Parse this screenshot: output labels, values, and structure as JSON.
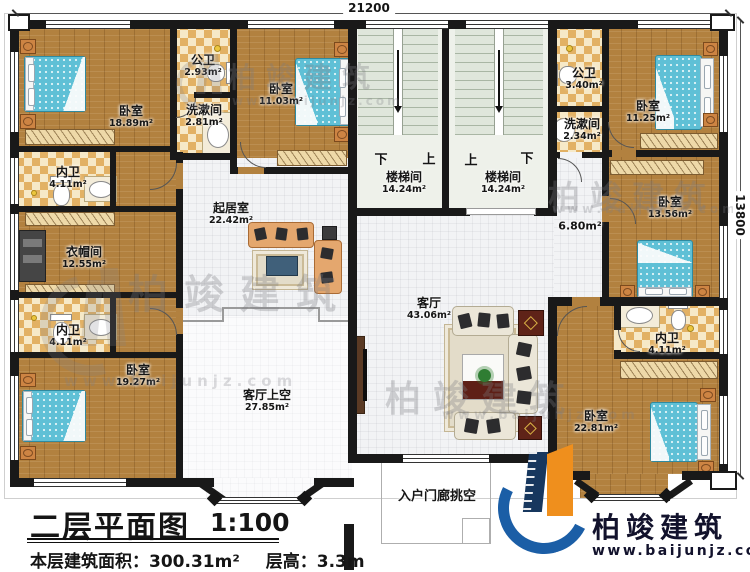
{
  "dimensions": {
    "top_width": "21200",
    "right_height": "13800"
  },
  "stairs": {
    "left": {
      "left_label": "下",
      "right_label": "上"
    },
    "right": {
      "left_label": "上",
      "right_label": "下"
    }
  },
  "rooms": {
    "bedroom_tl": {
      "name": "卧室",
      "area": "18.89m²"
    },
    "gongwei_tl": {
      "name": "公卫",
      "area": "2.93m²"
    },
    "xishujian_tl": {
      "name": "洗漱间",
      "area": "2.81m²"
    },
    "bedroom_tm": {
      "name": "卧室",
      "area": "11.03m²"
    },
    "neiwei_tl": {
      "name": "内卫",
      "area": "4.11m²"
    },
    "yimaojian": {
      "name": "衣帽间",
      "area": "12.55m²"
    },
    "neiwei_bl": {
      "name": "内卫",
      "area": "4.11m²"
    },
    "bedroom_bl": {
      "name": "卧室",
      "area": "19.27m²"
    },
    "qijushi": {
      "name": "起居室",
      "area": "22.42m²"
    },
    "stair_left": {
      "name": "楼梯间",
      "area": "14.24m²"
    },
    "stair_right": {
      "name": "楼梯间",
      "area": "14.24m²"
    },
    "gongwei_tr": {
      "name": "公卫",
      "area": "3.40m²"
    },
    "xishujian_tr": {
      "name": "洗漱间",
      "area": "2.34m²"
    },
    "bedroom_tr": {
      "name": "卧室",
      "area": "11.25m²"
    },
    "bedroom_mr": {
      "name": "卧室",
      "area": "13.56m²"
    },
    "hallway": {
      "area": "6.80m²"
    },
    "keting": {
      "name": "客厅",
      "area": "43.06m²"
    },
    "neiwei_r": {
      "name": "内卫",
      "area": "4.11m²"
    },
    "bedroom_br": {
      "name": "卧室",
      "area": "22.81m²"
    },
    "keting_void": {
      "name": "客厅上空",
      "area": "27.85m²"
    },
    "porch_void": {
      "name": "入户门廊挑空"
    }
  },
  "title": {
    "name": "二层平面图",
    "scale": "1:100",
    "area_label": "本层建筑面积：",
    "area_value": "300.31m²",
    "height_label": "层高：",
    "height_value": "3.3m"
  },
  "brand": {
    "name": "柏竣建筑",
    "url": "www.baijunjz.com"
  },
  "colors": {
    "wall": "#191919",
    "wood_floor": "#b2813f",
    "tile": "#e2b164",
    "bed": "#5fc0d6",
    "logo_blue": "#1b5ea6",
    "logo_orange": "#ef8f1d"
  }
}
